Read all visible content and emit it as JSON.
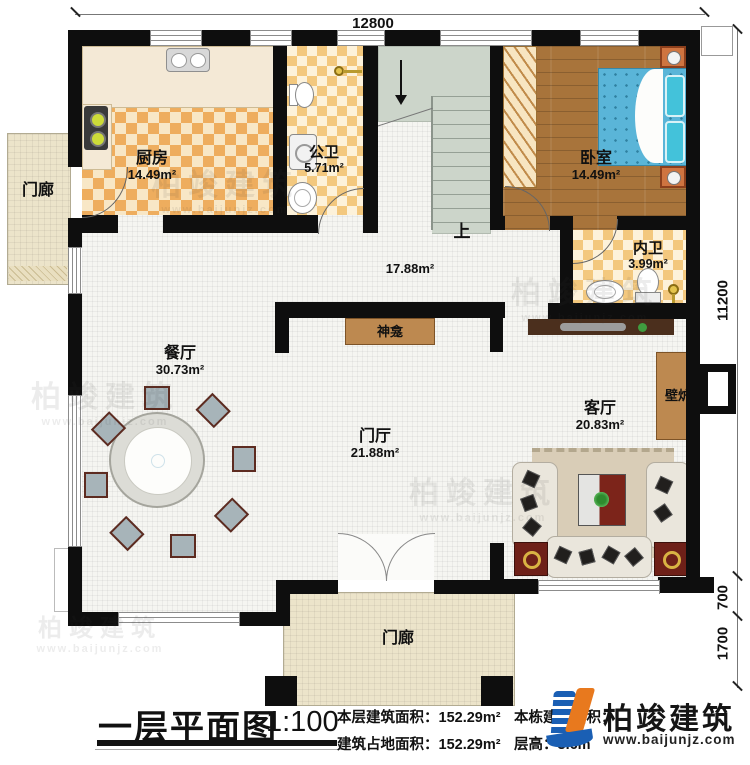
{
  "dimensions": {
    "top": "12800",
    "right_total": "11200",
    "right_mid": "700",
    "right_bottom": "1700"
  },
  "rooms": {
    "kitchen": {
      "name": "厨房",
      "area": "14.49m²"
    },
    "public_bath": {
      "name": "公卫",
      "area": "5.71m²"
    },
    "bedroom": {
      "name": "卧室",
      "area": "14.49m²"
    },
    "ensuite_bath": {
      "name": "内卫",
      "area": "3.99m²"
    },
    "hall": {
      "area": "17.88m²"
    },
    "dining": {
      "name": "餐厅",
      "area": "30.73m²"
    },
    "foyer": {
      "name": "门厅",
      "area": "21.88m²"
    },
    "living": {
      "name": "客厅",
      "area": "20.83m²"
    },
    "porch_left": {
      "name": "门廊"
    },
    "porch_bottom": {
      "name": "门廊"
    }
  },
  "features": {
    "shrine": "神龛",
    "fireplace": "壁炉",
    "stairs_up": "上"
  },
  "title_block": {
    "title": "一层平面图",
    "scale": "1:100",
    "stats": [
      {
        "label": "本层建筑面积：",
        "value": "152.29m²"
      },
      {
        "label": "本栋建筑面积：",
        "value": ""
      },
      {
        "label": "建筑占地面积：",
        "value": "152.29m²"
      },
      {
        "label": "层高：",
        "value": "3.6m"
      }
    ]
  },
  "logo": {
    "name": "柏竣建筑",
    "website": "www.baijunjz.com"
  },
  "watermark": {
    "text": "柏竣建筑",
    "sub": "www.baijunjz.com"
  },
  "colors": {
    "wall": "#0e0e0e",
    "accent_brown": "#bd8950",
    "kitchen_checker": "#eead5e",
    "bath_checker": "#f3c87e",
    "wood": "#a8743b",
    "bed_blue": "#5ab5d8",
    "logo_blue": "#1a5fb4",
    "logo_orange": "#e8791e"
  }
}
